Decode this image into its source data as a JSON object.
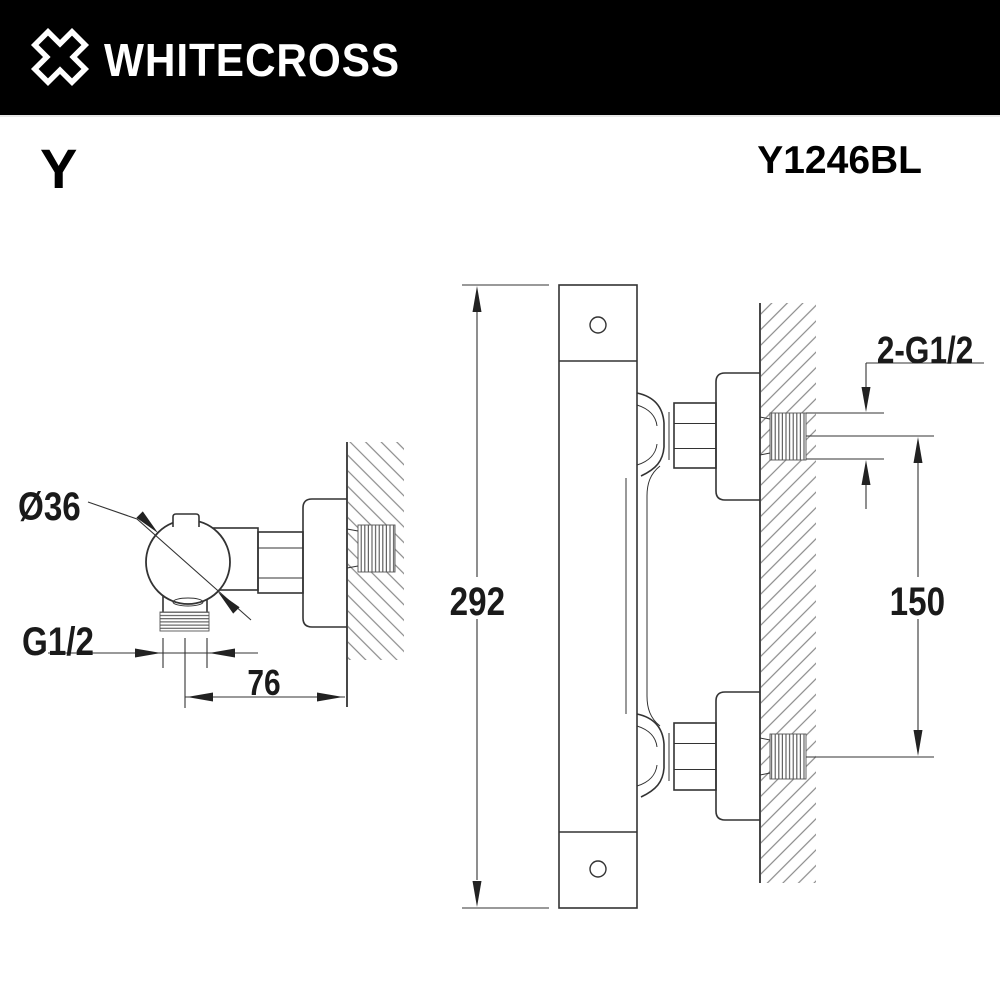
{
  "header": {
    "brand": "WHITECROSS",
    "logo_icon": "x-cross-icon",
    "bg_color": "#000000",
    "text_color": "#ffffff"
  },
  "product": {
    "series_label": "Y",
    "model_code": "Y1246BL"
  },
  "drawing": {
    "side_view": {
      "title": "side-projection-of-wall-mounted-valve",
      "labels": {
        "knob_diameter": "Ø36",
        "outlet_thread": "G1/2",
        "depth_from_wall": "76"
      }
    },
    "front_view": {
      "title": "profile-of-thermostatic-bar",
      "labels": {
        "total_height": "292",
        "inlet_spacing": "150",
        "inlet_threads": "2-G1/2"
      }
    },
    "line_color": "#333333",
    "hatch_color": "#8a8a8a"
  }
}
